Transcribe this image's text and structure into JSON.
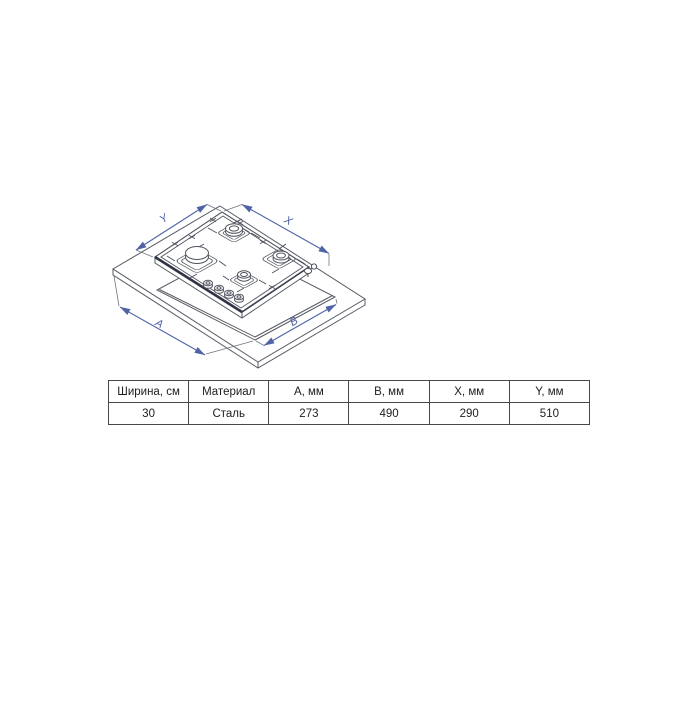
{
  "diagram": {
    "labels": {
      "y": "Y",
      "x": "X",
      "a": "A",
      "b": "B"
    },
    "colors": {
      "dimension_blue": "#4f63a6",
      "line_gray": "#50545e",
      "edge_dark": "#2f3447"
    }
  },
  "table": {
    "headers": [
      "Ширина, см",
      "Материал",
      "A, мм",
      "B, мм",
      "X, мм",
      "Y, мм"
    ],
    "values": [
      "30",
      "Сталь",
      "273",
      "490",
      "290",
      "510"
    ]
  }
}
